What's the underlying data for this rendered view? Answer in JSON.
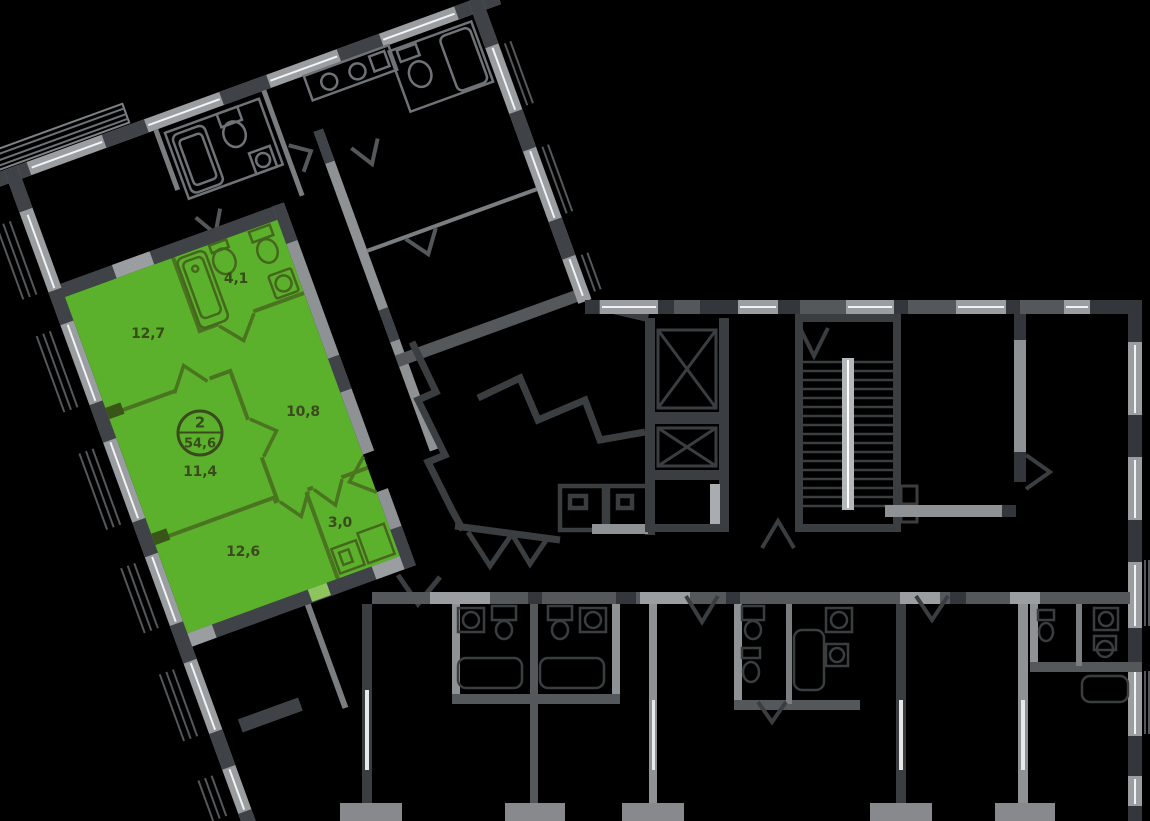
{
  "plan": {
    "type": "floor-plan",
    "highlight_color": "#5cb12c",
    "wall_dark_color": "#3a3e42",
    "wall_light_color": "#95989b",
    "label_color": "#394b1c",
    "badge": {
      "rooms_count": "2",
      "total_area": "54,6"
    },
    "rooms": [
      {
        "name": "room-top",
        "label": "12,7"
      },
      {
        "name": "bathroom",
        "label": "4,1"
      },
      {
        "name": "hallway",
        "label": "10,8"
      },
      {
        "name": "room-middle",
        "label": "11,4"
      },
      {
        "name": "closet",
        "label": "3,0"
      },
      {
        "name": "room-bottom",
        "label": "12,6"
      }
    ]
  }
}
